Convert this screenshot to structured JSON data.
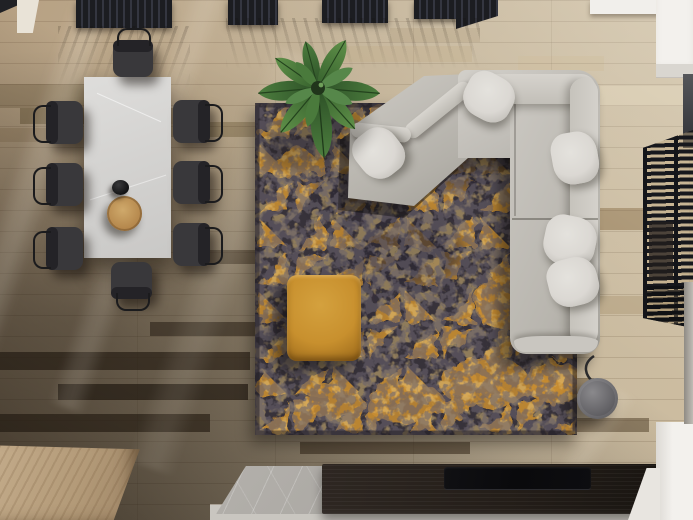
{
  "scene": {
    "type": "3d-render-top-down-view",
    "description": "Top-down view of a modern living room: dining table with eight dark chairs, potted banana plant, distressed charcoal rug with gold triangle pattern, light gray L-shaped sectional sofa with angled chaise and pillows, mustard pouf, gray drum floor lamp, dark wood TV console with flat TV, marble slab, light wood bench, dark slatted window blinds and ceiling slat panels on warm wood plank flooring.",
    "objects": {
      "dining_table": {
        "label": "White stone dining table",
        "items_on_top": [
          "black teapot",
          "wooden serving bowl"
        ]
      },
      "dining_chairs": {
        "label": "Dark dining chairs",
        "count": 8
      },
      "rug": {
        "label": "Distressed charcoal rug with gold triangle pattern"
      },
      "sofa": {
        "label": "Light gray L-shaped sectional sofa with angled chaise",
        "pillow_count": 5
      },
      "pouf": {
        "label": "Mustard yellow fabric pouf"
      },
      "plant": {
        "label": "Potted banana plant"
      },
      "floor_lamp": {
        "label": "Gray drum floor lamp"
      },
      "tv_console": {
        "label": "Dark wood TV console"
      },
      "tv": {
        "label": "Flat black TV panel"
      },
      "stone_slab": {
        "label": "Gray marble slab"
      },
      "wood_block": {
        "label": "Light wood bench block"
      },
      "blinds": {
        "label": "Dark slatted window blinds"
      },
      "ceiling_slats": {
        "label": "Dark ceiling slat panels"
      },
      "white_cabinet_top": {
        "label": "White cabinet, top right"
      },
      "white_cabinet_bottom": {
        "label": "White cabinet, bottom right"
      }
    }
  },
  "palette": {
    "floor_light": "#cdbda1",
    "floor_mid": "#b7a183",
    "floor_dark": "#4d4133",
    "rug_base": "#37323a",
    "rug_accent": "#c98e33",
    "pouf": "#c8902e",
    "sofa": "#c6c3bd",
    "pillow": "#dbd8d3",
    "table": "#d6d5d3",
    "chair": "#39383b",
    "plant_green": "#3e6b33",
    "console_wood": "#231d18",
    "tv_black": "#0a0a0c",
    "marble_gray": "#a9a6a1",
    "lamp_gray": "#636266",
    "blinds_dark": "#17181d",
    "cabinet_white": "#f3f1ed",
    "wood_block": "#b39a78"
  }
}
